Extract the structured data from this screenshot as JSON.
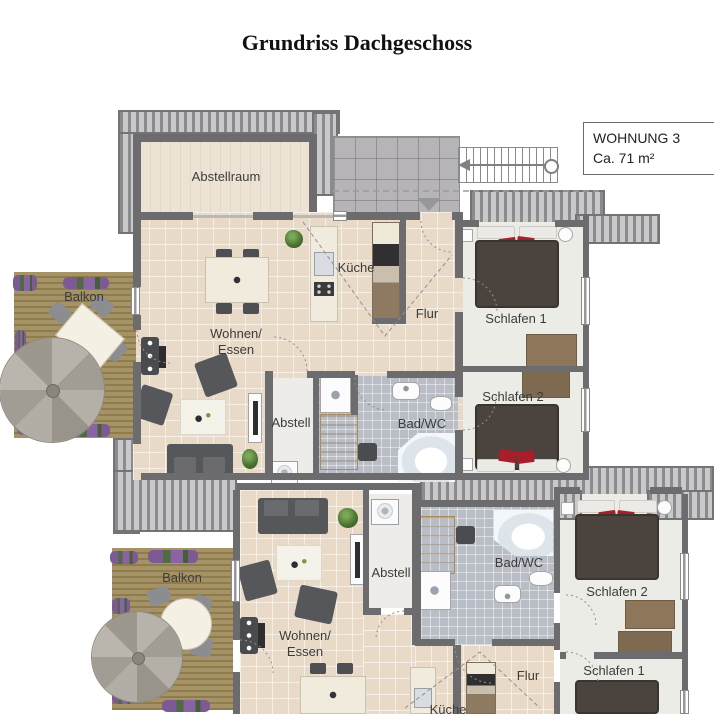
{
  "title": "Grundriss Dachgeschoss",
  "info_box": {
    "title": "WOHNUNG 3",
    "area": "Ca. 71 m²"
  },
  "apartment_top": {
    "abstellraum": "Abstellraum",
    "balkon": "Balkon",
    "wohnen_essen": "Wohnen/\nEssen",
    "kueche": "Küche",
    "flur": "Flur",
    "schlafen_1": "Schlafen 1",
    "schlafen_2": "Schlafen 2",
    "abstell": "Abstell",
    "bad_wc": "Bad/WC"
  },
  "apartment_bottom": {
    "balkon": "Balkon",
    "wohnen_essen": "Wohnen/\nEssen",
    "abstell": "Abstell",
    "bad_wc": "Bad/WC",
    "schlafen_2": "Schlafen 2",
    "schlafen_1": "Schlafen 1",
    "flur": "Flur",
    "kueche": "Küche"
  },
  "colors": {
    "wall": "#6c6c6f",
    "floor_tile": "#e8dac7",
    "bath_tile": "#b9bdc5",
    "bedroom_floor": "#ebece6",
    "wood_deck": "#a59367",
    "bed": "#4b443e",
    "accent_red": "#a81e2a",
    "furniture": "#56575b"
  }
}
